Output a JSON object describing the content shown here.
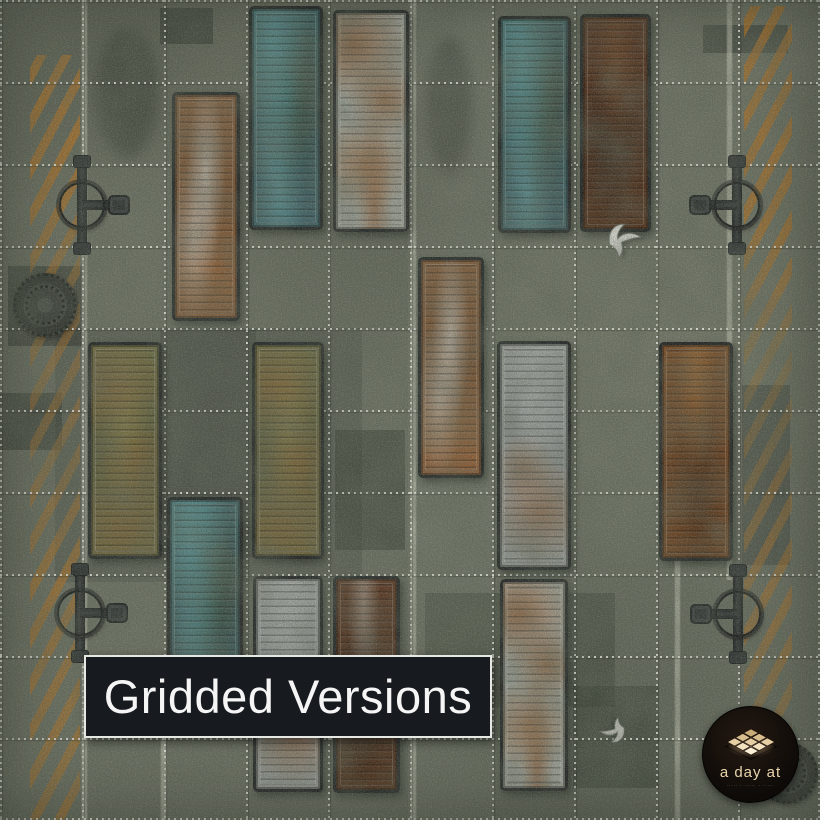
{
  "banner": {
    "label": "Gridded Versions"
  },
  "logo": {
    "brand": "a day at",
    "tagline": "·····  ·  ·····  ·  ·····"
  },
  "colors": {
    "ground": "#6e7465",
    "grid_dots": "#f9f9f1",
    "hazard_orange": "#ba741f",
    "banner_bg": "#171a1f",
    "banner_border": "#e6e8e4",
    "banner_text": "#f5f5f5",
    "logo_bg": "#0e0b08",
    "logo_text": "#e9d4ae",
    "container_teal": "#3d6b70",
    "container_white": "#b8bcb4",
    "container_olive": "#6e6d40",
    "container_brown": "#7d4a20",
    "container_darkbrown": "#50280f"
  },
  "map": {
    "grid": {
      "cols": 10,
      "rows": 10,
      "cell_px": 82,
      "style": "dotted-white"
    },
    "containers": [
      {
        "x": 249,
        "y": 6,
        "w": 74,
        "h": 224,
        "color": "teal"
      },
      {
        "x": 333,
        "y": 10,
        "w": 76,
        "h": 222,
        "color": "white"
      },
      {
        "x": 498,
        "y": 16,
        "w": 73,
        "h": 217,
        "color": "teal"
      },
      {
        "x": 580,
        "y": 14,
        "w": 71,
        "h": 218,
        "color": "darkbrown"
      },
      {
        "x": 172,
        "y": 92,
        "w": 68,
        "h": 229,
        "color": "rustwhite"
      },
      {
        "x": 88,
        "y": 342,
        "w": 74,
        "h": 217,
        "color": "olive"
      },
      {
        "x": 252,
        "y": 342,
        "w": 72,
        "h": 217,
        "color": "olive"
      },
      {
        "x": 418,
        "y": 257,
        "w": 66,
        "h": 221,
        "color": "rustwhite"
      },
      {
        "x": 497,
        "y": 341,
        "w": 74,
        "h": 229,
        "color": "graywhite"
      },
      {
        "x": 659,
        "y": 342,
        "w": 74,
        "h": 219,
        "color": "brown"
      },
      {
        "x": 167,
        "y": 497,
        "w": 76,
        "h": 226,
        "color": "teal"
      },
      {
        "x": 253,
        "y": 576,
        "w": 70,
        "h": 216,
        "color": "graywhite"
      },
      {
        "x": 333,
        "y": 576,
        "w": 67,
        "h": 217,
        "color": "darkbrown2"
      },
      {
        "x": 500,
        "y": 579,
        "w": 68,
        "h": 212,
        "color": "white"
      }
    ],
    "valves": [
      {
        "x": 82,
        "y": 205,
        "arm": "right"
      },
      {
        "x": 737,
        "y": 205,
        "arm": "left"
      },
      {
        "x": 80,
        "y": 613,
        "arm": "right"
      },
      {
        "x": 738,
        "y": 614,
        "arm": "left"
      }
    ],
    "manholes": [
      {
        "x": 45,
        "y": 305,
        "d": 64
      },
      {
        "x": 787,
        "y": 773,
        "d": 62
      }
    ],
    "birds": [
      {
        "x": 628,
        "y": 237,
        "rot": -35,
        "s": 1,
        "tone": "light"
      },
      {
        "x": 610,
        "y": 728,
        "rot": 150,
        "s": 0.75,
        "tone": "gray"
      }
    ],
    "hazard_bands": [
      {
        "x": 30,
        "y": 55,
        "w": 50,
        "h": 765,
        "fade": "left"
      },
      {
        "x": 744,
        "y": 6,
        "w": 48,
        "h": 730,
        "fade": "right"
      }
    ],
    "lane_lines": [
      {
        "x": 81,
        "y1": 0,
        "y2": 820
      },
      {
        "x": 160,
        "y1": 738,
        "y2": 820
      },
      {
        "x": 410,
        "y1": 0,
        "y2": 820
      },
      {
        "x": 726,
        "y1": 0,
        "y2": 580
      },
      {
        "x": 674,
        "y1": 560,
        "y2": 820
      }
    ],
    "ground_patches": [
      {
        "x": 160,
        "y": 8,
        "w": 53,
        "h": 36,
        "c": "rgba(38,44,36,0.55)"
      },
      {
        "x": 703,
        "y": 25,
        "w": 85,
        "h": 28,
        "c": "rgba(38,44,36,0.5)"
      },
      {
        "x": 55,
        "y": 328,
        "w": 307,
        "h": 254,
        "c": "rgba(33,38,30,0.22)"
      },
      {
        "x": 160,
        "y": 330,
        "w": 96,
        "h": 228,
        "c": "rgba(28,33,26,0.22)"
      },
      {
        "x": 335,
        "y": 430,
        "w": 70,
        "h": 120,
        "c": "rgba(30,40,28,0.40)"
      },
      {
        "x": 425,
        "y": 593,
        "w": 190,
        "h": 114,
        "c": "rgba(30,40,28,0.33)"
      },
      {
        "x": 742,
        "y": 385,
        "w": 48,
        "h": 180,
        "c": "rgba(48,54,48,0.45)"
      },
      {
        "x": 0,
        "y": 393,
        "w": 62,
        "h": 57,
        "c": "rgba(33,38,31,0.45)"
      },
      {
        "x": 8,
        "y": 266,
        "w": 76,
        "h": 80,
        "c": "rgba(33,38,31,0.50)"
      },
      {
        "x": 573,
        "y": 686,
        "w": 86,
        "h": 102,
        "c": "rgba(30,40,28,0.40)"
      },
      {
        "x": 408,
        "y": 0,
        "w": 86,
        "h": 820,
        "c": "rgba(210,214,196,0.06)"
      },
      {
        "x": 96,
        "y": 28,
        "w": 64,
        "h": 130,
        "c": "rgba(24,28,20,0.35)",
        "round": true,
        "blur": true
      },
      {
        "x": 425,
        "y": 35,
        "w": 48,
        "h": 140,
        "c": "rgba(24,28,20,0.30)",
        "round": true,
        "blur": true
      }
    ]
  }
}
